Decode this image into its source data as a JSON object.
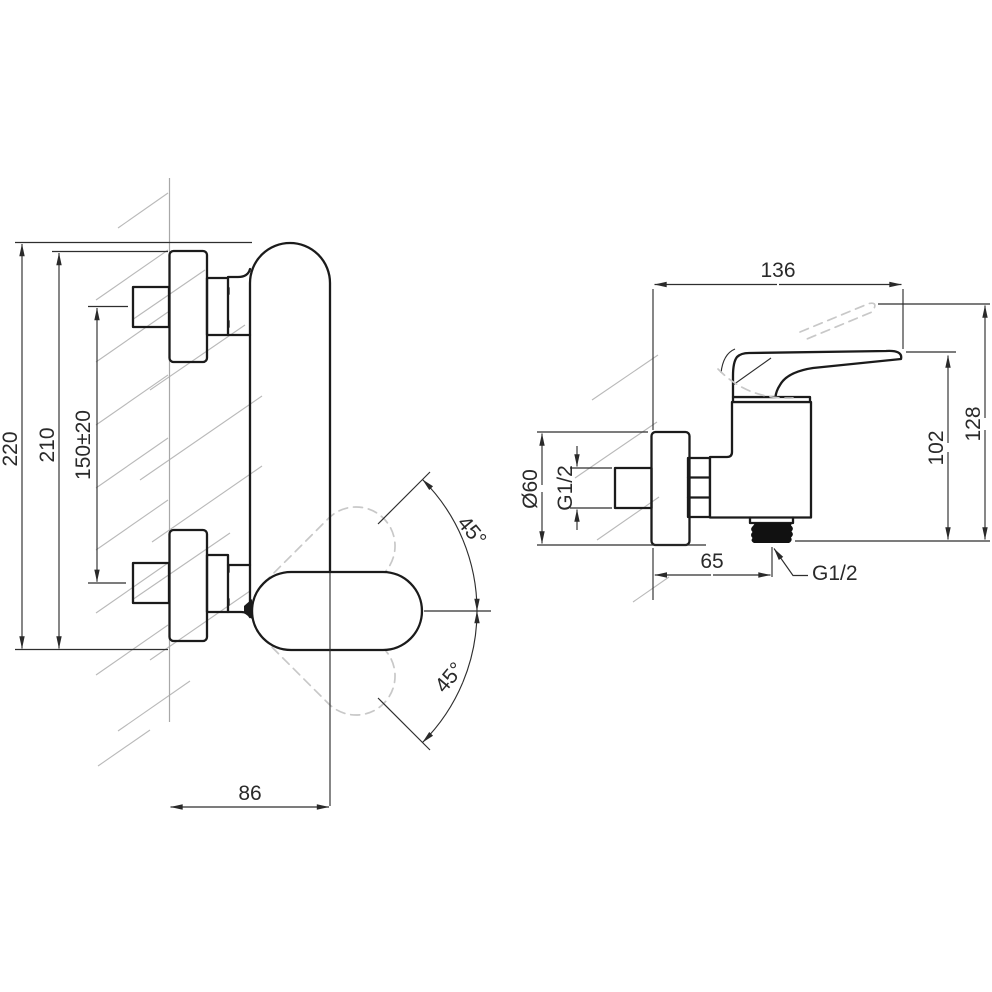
{
  "drawing": {
    "kind": "technical-dimension-drawing",
    "subject": "wall-mounted single-lever shower mixer, two orthographic views"
  },
  "side_view": {
    "dim_overall_height": "220",
    "dim_height_to_escutcheon": "210",
    "dim_inlet_spacing": "150±20",
    "dim_depth_from_wall": "86",
    "dim_handle_swing_up": "45°",
    "dim_handle_swing_down": "45°"
  },
  "front_view": {
    "dim_overall_width": "136",
    "dim_escutcheon_diameter": "Ø60",
    "dim_inlet_thread": "G1/2",
    "dim_outlet_offset": "65",
    "dim_outlet_thread": "G1/2",
    "dim_body_height": "102",
    "dim_height_with_lever": "128"
  },
  "colors": {
    "outline": "#1b1b1b",
    "dimension": "#2a2a2a",
    "hatch": "#b9b9b9",
    "ghost": "#c8c8c8",
    "knurl": "#111111",
    "background": "#ffffff"
  }
}
